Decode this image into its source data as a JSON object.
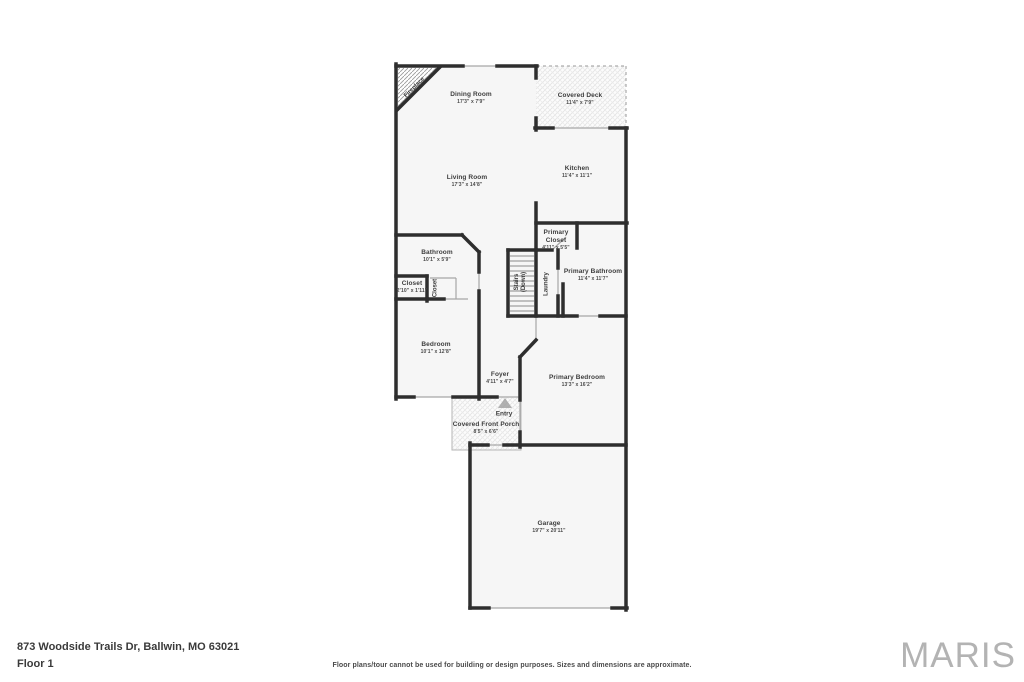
{
  "footer": {
    "address": "873 Woodside Trails Dr, Ballwin, MO 63021",
    "floor_label": "Floor 1",
    "disclaimer": "Floor plans/tour cannot be used for building or design purposes. Sizes and dimensions are approximate.",
    "brand": "MARIS"
  },
  "rooms": {
    "dining": {
      "name": "Dining Room",
      "dims": "17'3\" x 7'9\""
    },
    "deck": {
      "name": "Covered Deck",
      "dims": "11'4\" x 7'9\""
    },
    "living": {
      "name": "Living Room",
      "dims": "17'3\" x 14'8\""
    },
    "kitchen": {
      "name": "Kitchen",
      "dims": "11'4\" x 11'1\""
    },
    "bathroom": {
      "name": "Bathroom",
      "dims": "10'1\" x 5'9\""
    },
    "primary_closet": {
      "name": "Primary Closet",
      "dims": "4'11\" x 5'5\""
    },
    "primary_bathroom": {
      "name": "Primary Bathroom",
      "dims": "11'4\" x 11'7\""
    },
    "closet": {
      "name": "Closet",
      "dims": "2'10\" x 1'11\""
    },
    "bedroom": {
      "name": "Bedroom",
      "dims": "10'1\" x 12'8\""
    },
    "foyer": {
      "name": "Foyer",
      "dims": "4'11\" x 4'7\""
    },
    "primary_bedroom": {
      "name": "Primary Bedroom",
      "dims": "13'3\" x 16'2\""
    },
    "porch": {
      "name": "Covered Front Porch",
      "dims": "8'5\" x 6'6\""
    },
    "garage": {
      "name": "Garage",
      "dims": "19'7\" x 20'11\""
    }
  },
  "annotations": {
    "fireplace": "Fireplace",
    "stairs_line1": "Stairs",
    "stairs_line2": "(Down)",
    "laundry": "Laundry",
    "closet_vertical": "Closet",
    "entry": "Entry"
  },
  "colors": {
    "wall": "#2e2e2e",
    "room_fill": "#f6f6f6",
    "text": "#3d3d3d",
    "brand_gray": "#b3b3b3"
  }
}
